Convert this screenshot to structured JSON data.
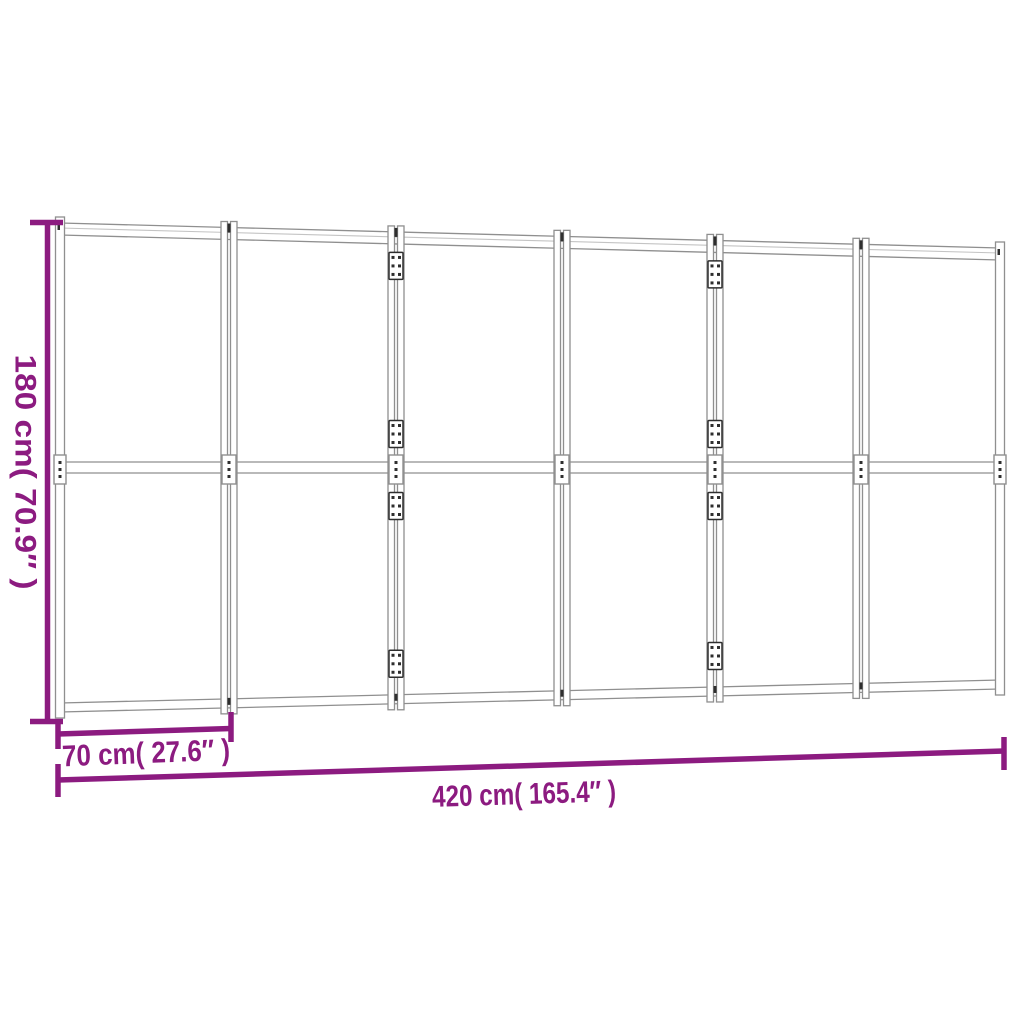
{
  "diagram": {
    "type": "product-dimension-diagram",
    "subject": "6-panel folding room divider, front view",
    "panel_count": 6
  },
  "dimensions": {
    "height": {
      "label": "180 cm( 70.9″ )",
      "cm": 180,
      "inches": 70.9
    },
    "panel_width": {
      "label": "70 cm( 27.6″ )",
      "cm": 70,
      "inches": 27.6
    },
    "total_width": {
      "label": "420 cm( 165.4″ )",
      "cm": 420,
      "inches": 165.4
    }
  },
  "colors": {
    "background": "#FFFFFF",
    "dimension": "#8C1B80",
    "frame": "#8F8F8F",
    "frame_light": "#C4C4C4",
    "hardware": "#2E2E2E"
  }
}
